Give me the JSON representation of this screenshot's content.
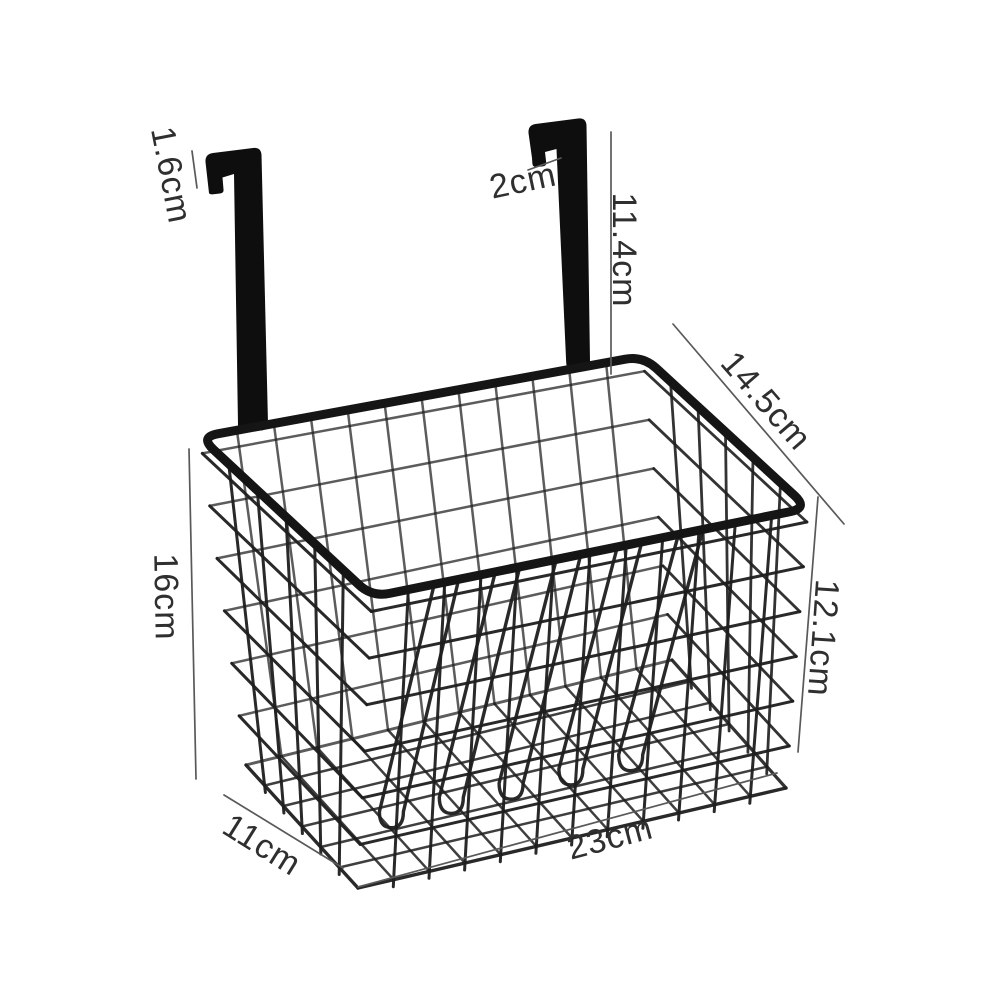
{
  "page": {
    "background": "#ffffff"
  },
  "figure": {
    "name": "over-door-hanging-wire-basket",
    "wire_color": "#1e1e1e",
    "rim_color": "#151515",
    "hook_color": "#0e0e0e",
    "dim_line_color": "#595959",
    "label_color": "#2f2f2f",
    "label_font_size": 34,
    "rim": {
      "back_left": [
        200,
        437
      ],
      "back_right": [
        643,
        356
      ],
      "front_right": [
        808,
        508
      ],
      "front_left": [
        372,
        597
      ]
    },
    "base": {
      "back_left": [
        246,
        765
      ],
      "back_right": [
        672,
        660
      ],
      "front_right": [
        786,
        788
      ],
      "front_left": [
        358,
        888
      ]
    },
    "grid": {
      "front_verticals": 11,
      "side_verticals": 5,
      "horizontal_levels": [
        0.05,
        0.21,
        0.37,
        0.53,
        0.69,
        0.85
      ]
    },
    "hairpins": {
      "t_values": [
        0.17,
        0.31,
        0.45,
        0.59,
        0.73
      ],
      "half_width": 12,
      "depth": 0.35
    },
    "hooks": {
      "left_path": "M 209 193 L 205.5 162 Q 205 154 213 153 L 253 148 Q 261 147 261.5 155 L 268 423 Q 268.3 430 261 430.5 L 245.5 431.5 Q 238.3 432 238 425 L 234 174 L 222.5 177.5 L 223.5 189.5 Q 224 193 220 193.5 L 213.5 194.3 Q 209.6 194.7 209 193 Z",
      "right_path": "M 532 158 L 528.5 133 Q 528 125 535.5 124 L 578 118.5 Q 586 117.5 586.5 125.5 L 590 361 Q 590.3 368 583 368.5 L 573.5 369.2 Q 566.6 369.7 566.2 362.7 L 556.5 149 L 545 152 L 546.2 162.5 Q 546.6 166 542.8 166.4 L 536.8 167 Q 533 167.4 532.4 164 Z"
    }
  },
  "dimensions": [
    {
      "label": "1.6cm",
      "x": 171,
      "y": 175,
      "rotate": 79,
      "line": [
        192,
        151,
        197,
        188
      ]
    },
    {
      "label": "2cm",
      "x": 523,
      "y": 181,
      "rotate": -12,
      "line": [
        528,
        170,
        561,
        158
      ]
    },
    {
      "label": "11.4cm",
      "x": 624,
      "y": 250,
      "rotate": 90,
      "line": [
        611,
        132,
        611,
        374
      ]
    },
    {
      "label": "14.5cm",
      "x": 766,
      "y": 401,
      "rotate": 49,
      "line": [
        673,
        324,
        844,
        524
      ]
    },
    {
      "label": "12.1cm",
      "x": 823,
      "y": 638,
      "rotate": 94,
      "line": [
        818,
        497,
        798,
        752
      ]
    },
    {
      "label": "16cm",
      "x": 166,
      "y": 597,
      "rotate": 89,
      "line": [
        189,
        449,
        196,
        779
      ]
    },
    {
      "label": "11cm",
      "x": 262,
      "y": 845,
      "rotate": 32,
      "line": [
        224,
        795,
        343,
        868
      ]
    },
    {
      "label": "23cm",
      "x": 610,
      "y": 838,
      "rotate": -15,
      "line": [
        358,
        887,
        777,
        773
      ]
    }
  ]
}
